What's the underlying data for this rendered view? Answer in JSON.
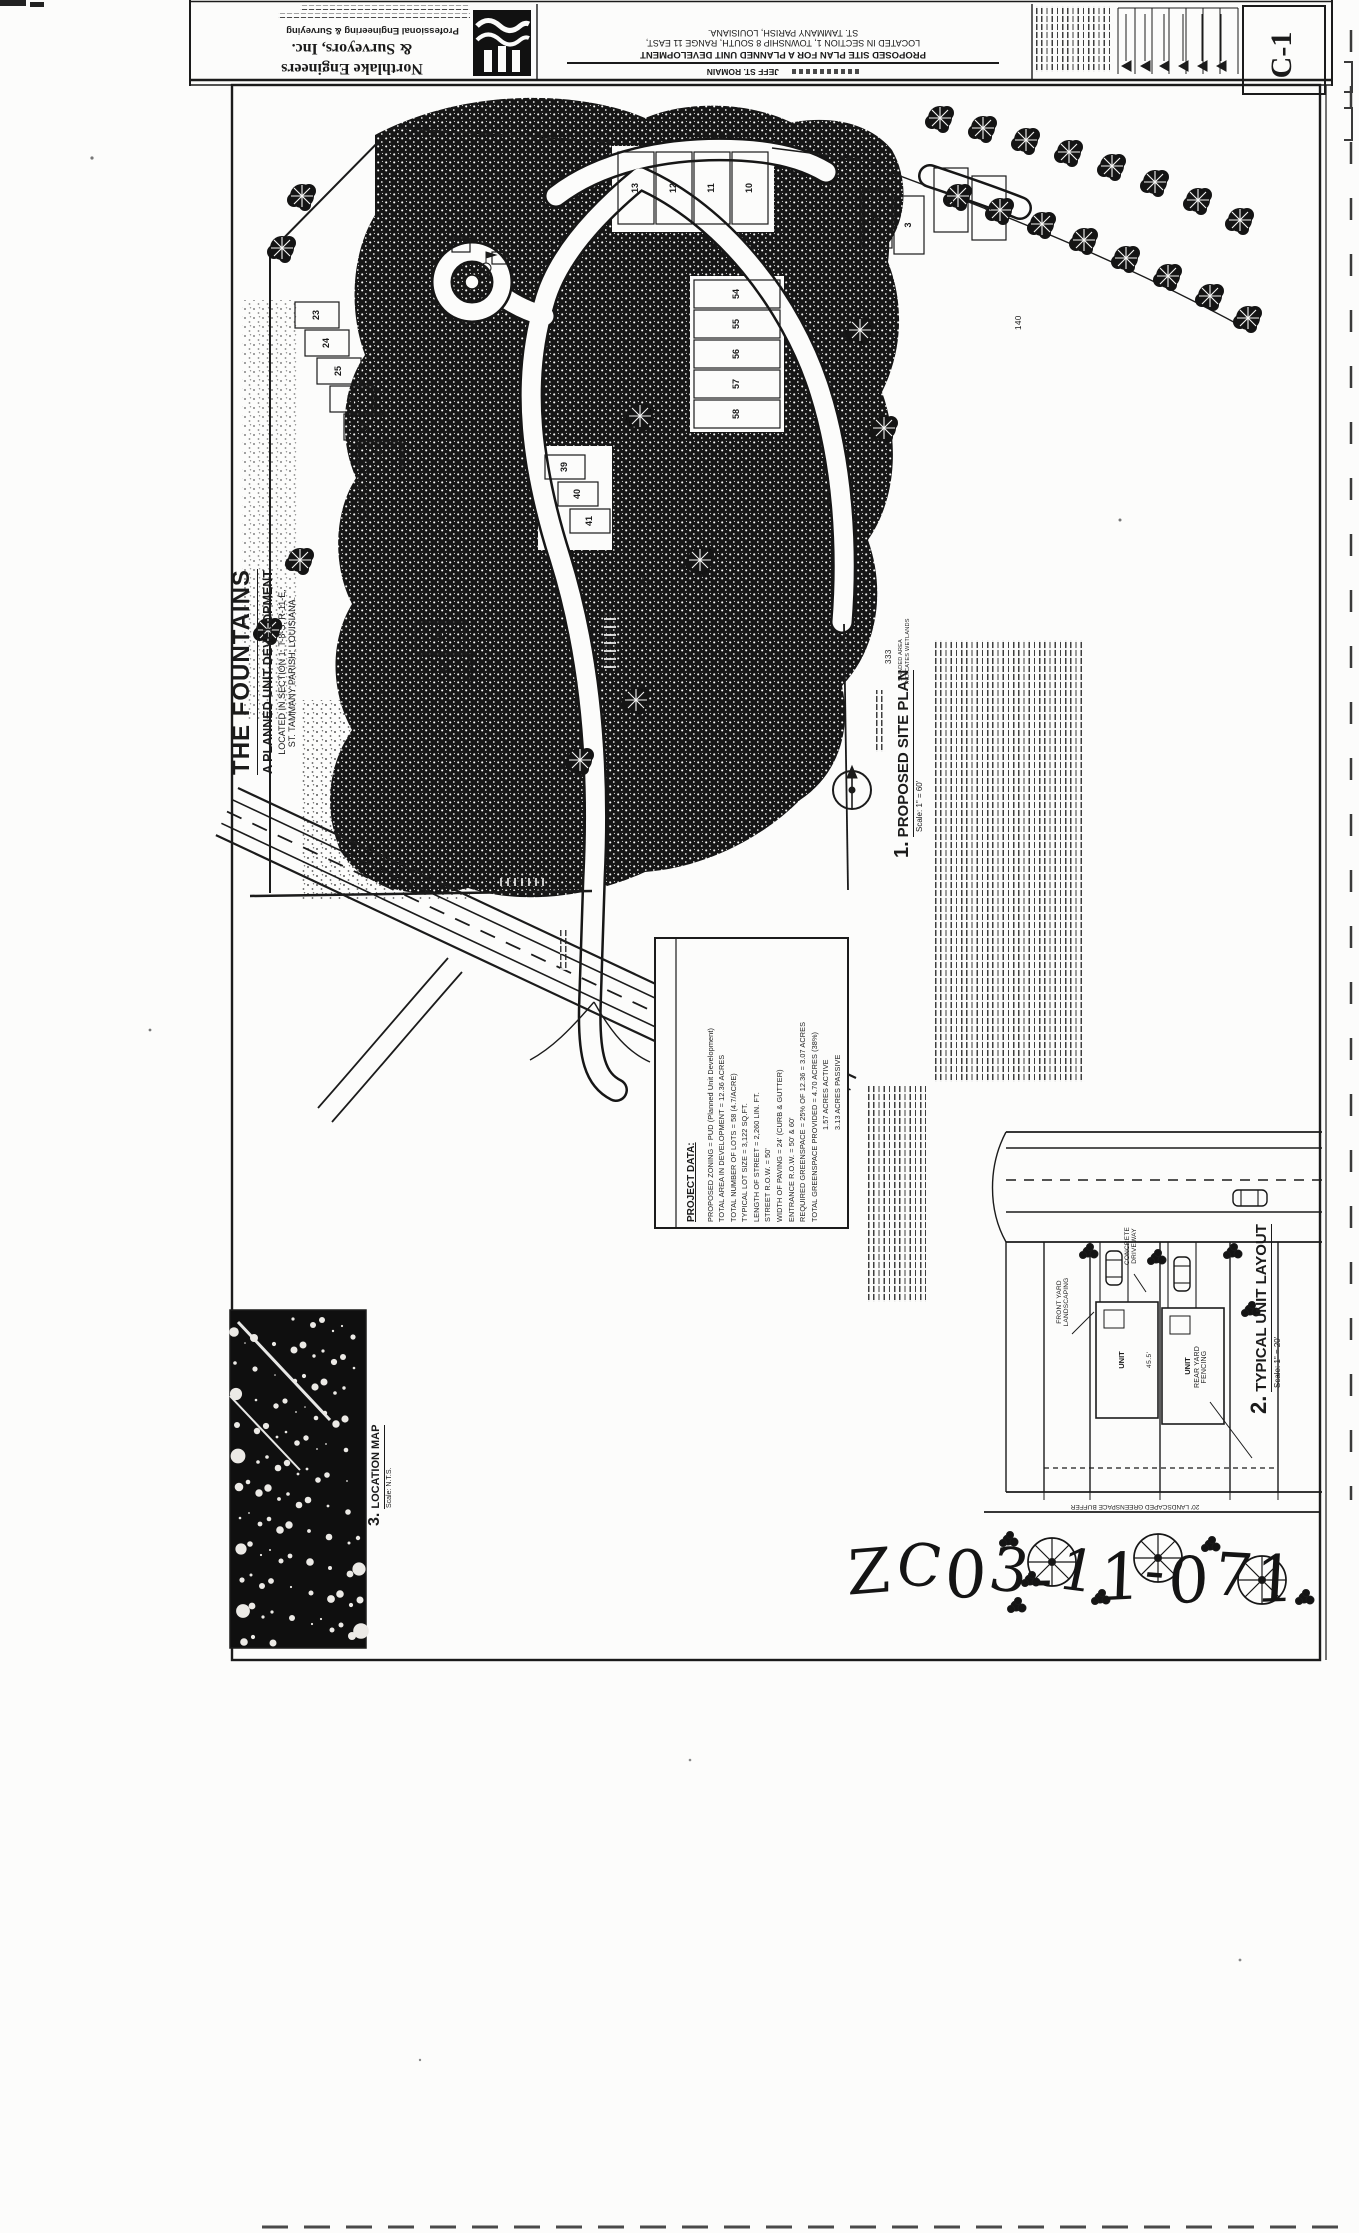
{
  "document": {
    "title_block": {
      "firm_name_line1": "Northlake Engineers",
      "firm_name_line2": "& Surveyors, Inc.",
      "firm_tagline": "Professional Engineering & Surveying",
      "project_title_line1": "PROPOSED SITE PLAN FOR A PLANNED UNIT DEVELOPMENT",
      "project_title_line2": "LOCATED IN SECTION 1, TOWNSHIP 8 SOUTH, RANGE 11 EAST,",
      "project_title_line3": "ST. TAMMANY PARISH, LOUISIANA.",
      "owner_name": "JEFF ST. ROMAIN",
      "sheet_number": "C-1"
    },
    "main_title": {
      "title": "THE FOUNTAINS",
      "subtitle": "A PLANNED UNIT DEVELOPMENT",
      "location_line1": "LOCATED IN SECTION 1, T-8-S, R-11-E,",
      "location_line2": "ST. TAMMANY PARISH, LOUISIANA."
    },
    "views": {
      "site_plan": {
        "number": "1.",
        "label": "PROPOSED SITE PLAN",
        "scale": "Scale: 1\" = 60'"
      },
      "unit_layout": {
        "number": "2.",
        "label": "TYPICAL UNIT LAYOUT",
        "scale": "Scale: 1\" = 20'"
      },
      "location_map": {
        "number": "3.",
        "label": "LOCATION MAP",
        "scale": "Scale: N.T.S."
      }
    },
    "project_data": {
      "heading": "PROJECT DATA:",
      "lines": [
        "PROPOSED ZONING = PUD (Planned Unit Development)",
        "TOTAL AREA IN DEVELOPMENT = 12.36 ACRES",
        "TOTAL NUMBER OF LOTS = 58 (4.7/ACRE)",
        "TYPICAL LOT SIZE = 3,122 SQ.FT.",
        "LENGTH OF STREET = 2,260 LIN. FT.",
        "STREET R.O.W. = 50'",
        "WIDTH OF PAVING = 24' (CURB & GUTTER)",
        "ENTRANCE R.O.W. = 50' & 60'",
        "REQUIRED GREENSPACE = 25% OF 12.36 = 3.07 ACRES",
        "TOTAL GREENSPACE PROVIDED = 4.70 ACRES (38%)",
        "1.57 ACRES ACTIVE",
        "3.13 ACRES PASSIVE"
      ]
    },
    "wetland_note_line1": "SHADED AREA",
    "wetland_note_line2": "INDICATES WETLANDS",
    "lots": {
      "top_row": [
        "13",
        "12",
        "11",
        "10"
      ],
      "right_row": [
        "2",
        "1"
      ],
      "right_row2": [
        "4",
        "3"
      ],
      "middle_column": [
        "54",
        "55",
        "56",
        "57",
        "58"
      ],
      "left_street": [
        "23",
        "24",
        "25",
        "26",
        "27",
        "28"
      ],
      "lower_left": [
        "29",
        "30"
      ],
      "interior": [
        "39",
        "40",
        "41"
      ]
    },
    "dimensions": {
      "d1": "1007",
      "d2": "333",
      "d3": "140",
      "d4": "127",
      "unit_dim": "45.5'"
    },
    "unit_layout_labels": {
      "unit": "UNIT",
      "rear_yard_line1": "REAR YARD",
      "rear_yard_line2": "FENCING",
      "concrete_line1": "CONCRETE",
      "concrete_line2": "DRIVEWAY",
      "front_yard_line1": "FRONT YARD",
      "front_yard_line2": "LANDSCAPING",
      "buffer": "20' LANDSCAPED GREENSPACE BUFFER"
    },
    "handwritten_case_number": "ZC03-11-071",
    "ink_color": "#1b1b1b"
  }
}
